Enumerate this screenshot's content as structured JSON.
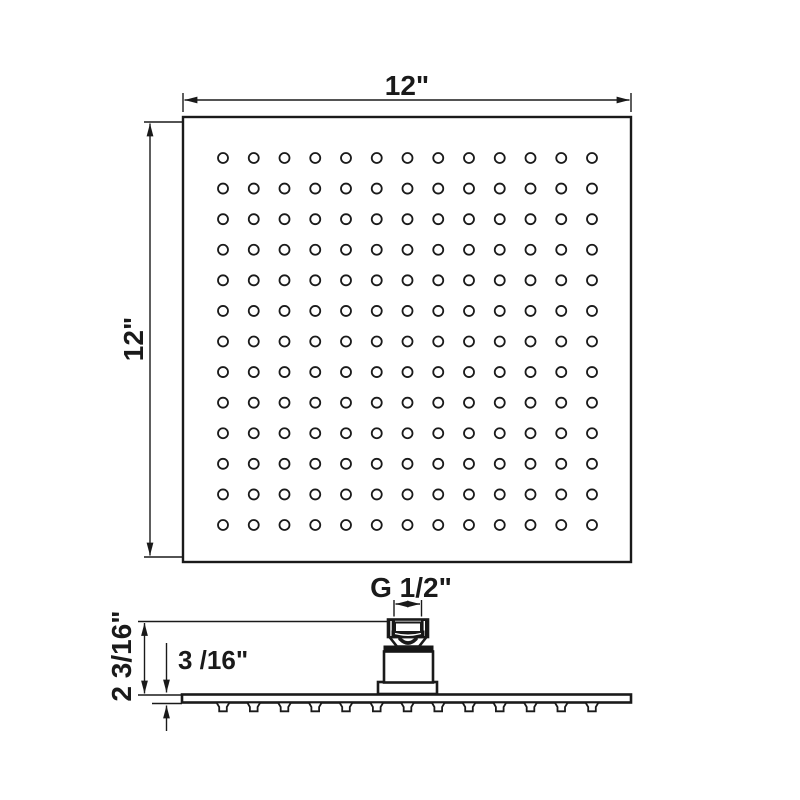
{
  "drawing": {
    "top_view": {
      "width_label": "12\"",
      "height_label": "12\"",
      "grid": {
        "rows": 13,
        "cols": 13
      }
    },
    "side_view": {
      "thread_label": "G 1/2\"",
      "overall_height_label": "2 3/16\"",
      "plate_thickness_label": "3 /16\"",
      "nozzle_count": 13
    },
    "colors": {
      "line": "#1a1a1a",
      "background": "#ffffff"
    }
  }
}
